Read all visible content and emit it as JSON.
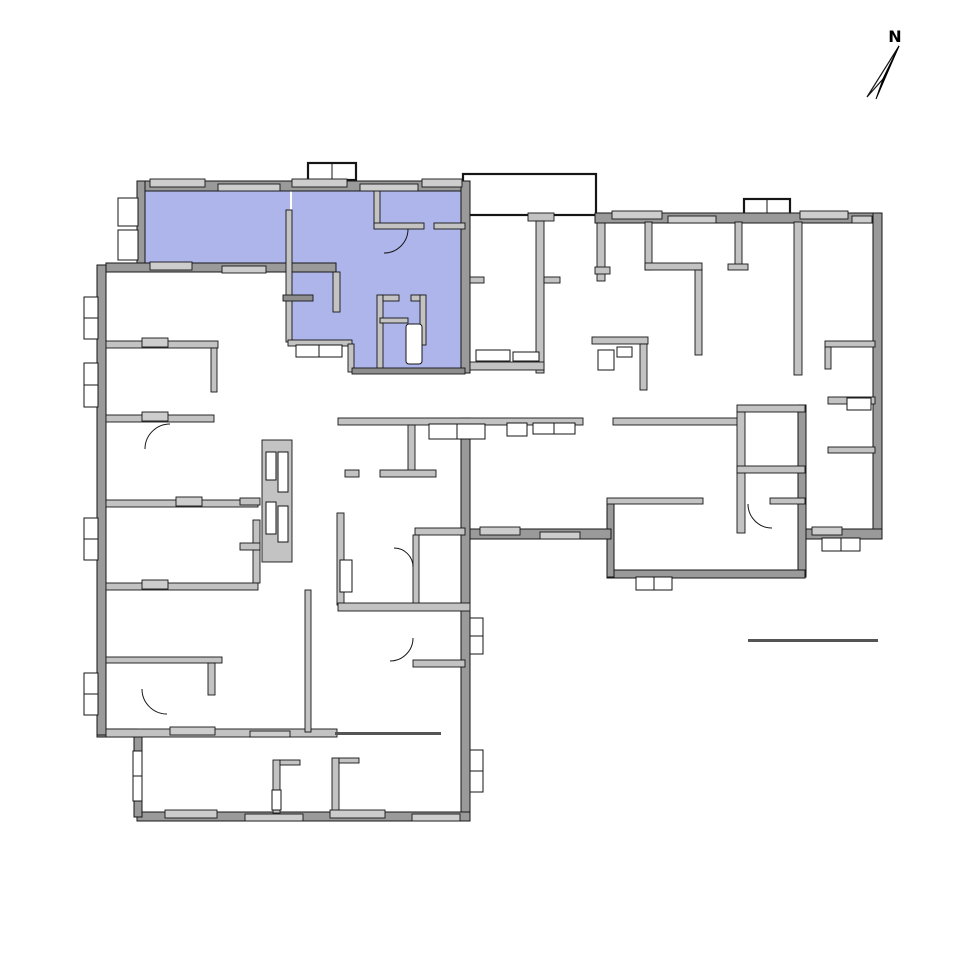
{
  "compass": {
    "label": "N"
  },
  "colors": {
    "background": "#ffffff",
    "highlight": "#adb5ea",
    "wall_fill": "#c3c3c3",
    "wall_exterior": "#9a9a9a",
    "wall_dark": "#8e8e8e",
    "outline": "#161616",
    "sill": "#cdcdcd"
  },
  "plan": {
    "type": "building-floor-plan",
    "highlighted_unit_position": "upper-left"
  }
}
